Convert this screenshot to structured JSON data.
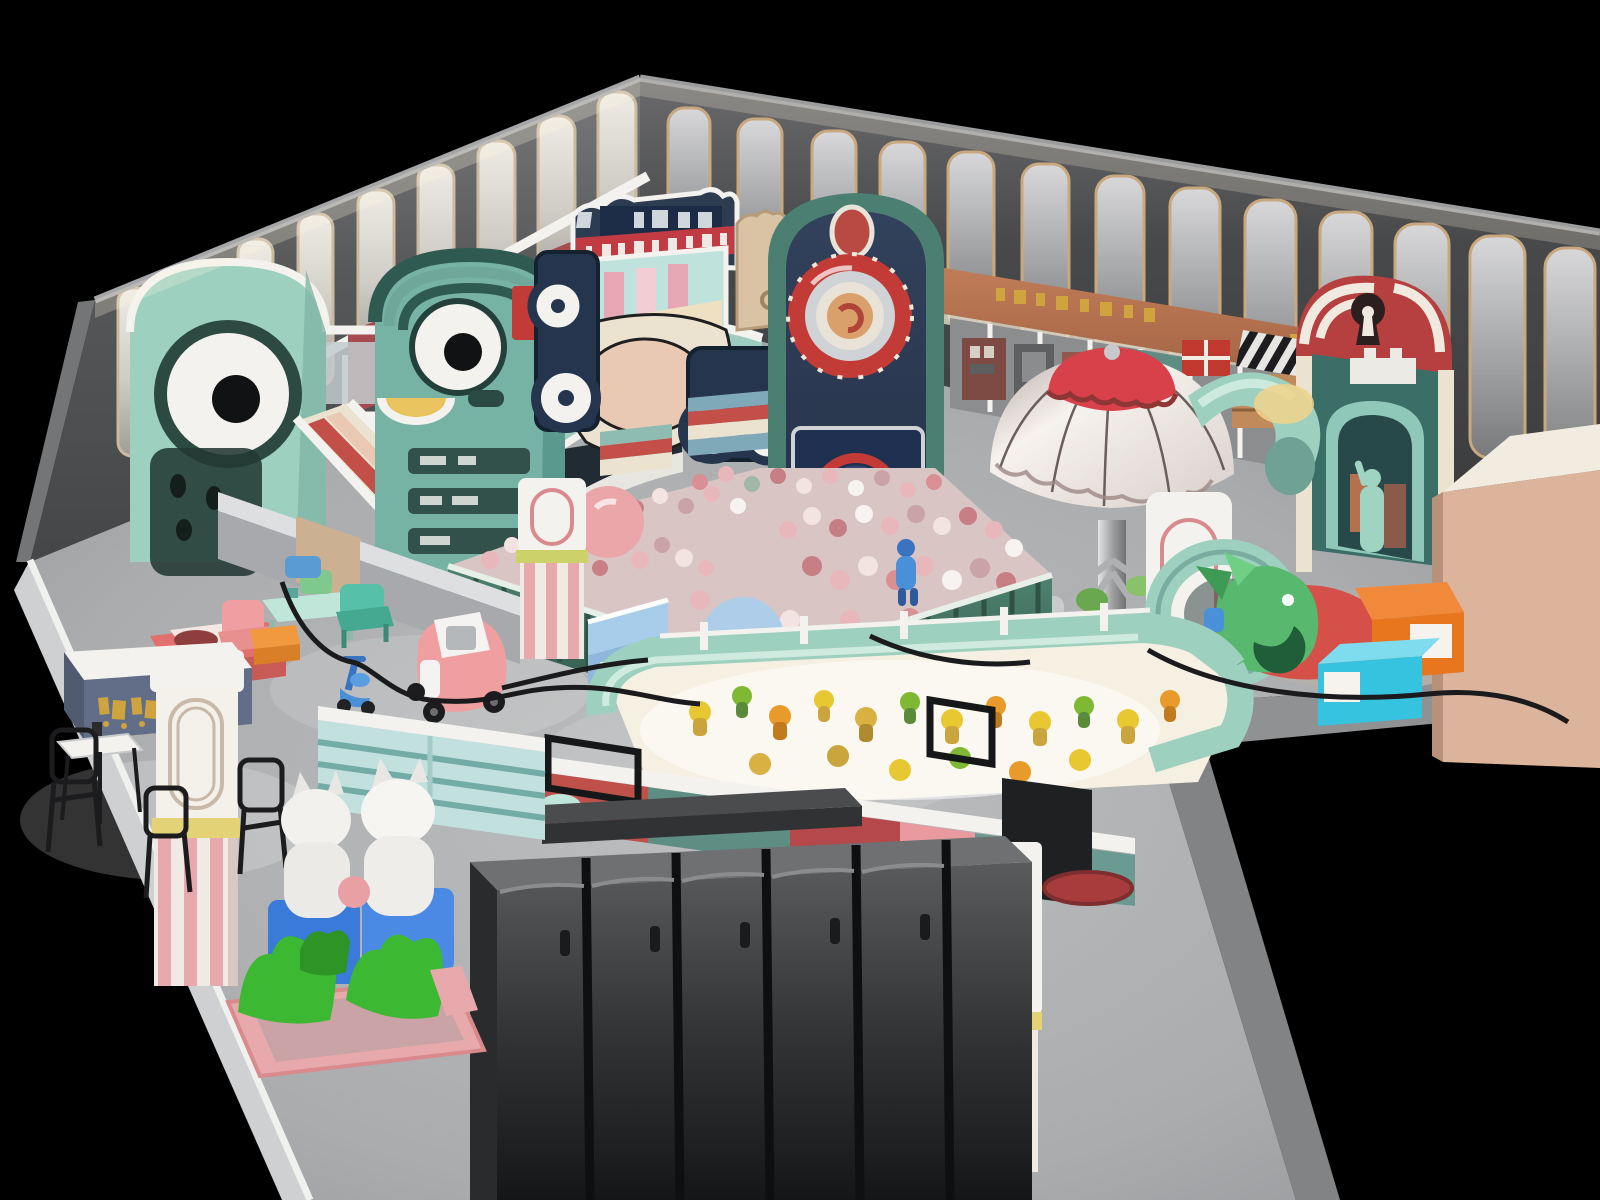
{
  "scene": {
    "title": "3D cutaway render of an indoor children's playground",
    "style": "isometric architectural visualization on black background",
    "areas": [
      "back-wall-with-lit-slats",
      "mint-eye-tower",
      "toddler-slide",
      "face-tower-with-smile",
      "car-theme-slide-marquee",
      "navy-arch-clock-tower",
      "storefront-sign-band",
      "striped-castle-gate",
      "parachute-carousel",
      "mint-tube-slide",
      "ball-pit",
      "sand-play-pit-with-figures",
      "counter-row-with-stools",
      "locker-bank",
      "kiddie-ride-with-white-figures",
      "cashier-desk",
      "cafe-tables-and-wire-chairs",
      "arched-pink-striped-columns",
      "toy-kart",
      "toy-scooter",
      "kids-furniture-set",
      "soft-blocks",
      "fish-play-sculpture",
      "beige-volume-box",
      "floor-cables"
    ]
  },
  "palette": {
    "bg": "#000000",
    "floor": "#aeb0b3",
    "floor_dim": "#8f9194",
    "wall_dark": "#47484a",
    "wall_dark2": "#3a3b3d",
    "slat": "#b9babc",
    "slat_trim": "#c9a87e",
    "slat_left": "#dcd9d3",
    "gray_mid": "#97999b",
    "outline": "#1c1c1e",
    "white": "#f3f2ef",
    "cream": "#ece2d0",
    "blush": "#e9c9b4",
    "mint": "#9ed0c0",
    "mint_light": "#c6e6db",
    "mint_deep": "#5f968a",
    "teal": "#77b3a5",
    "teal_dark": "#31605a",
    "fence_green": "#3e6b5c",
    "navy": "#2e3c52",
    "navy_deep": "#223047",
    "red": "#c23b36",
    "dome_red": "#d8404a",
    "rose": "#d98a8c",
    "pink": "#eba6a9",
    "pink_car": "#ef9f9f",
    "ball_pink": "#e8b7bb",
    "ball_deep": "#c77f85",
    "terracotta": "#b5714e",
    "gold": "#cfa43e",
    "grass": "#3cb832",
    "blue": "#4a90d9",
    "steel": "#7fa8b8",
    "cyan": "#35c3e0",
    "orange": "#e8761e",
    "beige_box": "#dcb49b",
    "charcoal": "#2e2f31",
    "locker": "#505254",
    "yellow_band": "#e3d276",
    "toy_yellow": "#e8c832"
  }
}
